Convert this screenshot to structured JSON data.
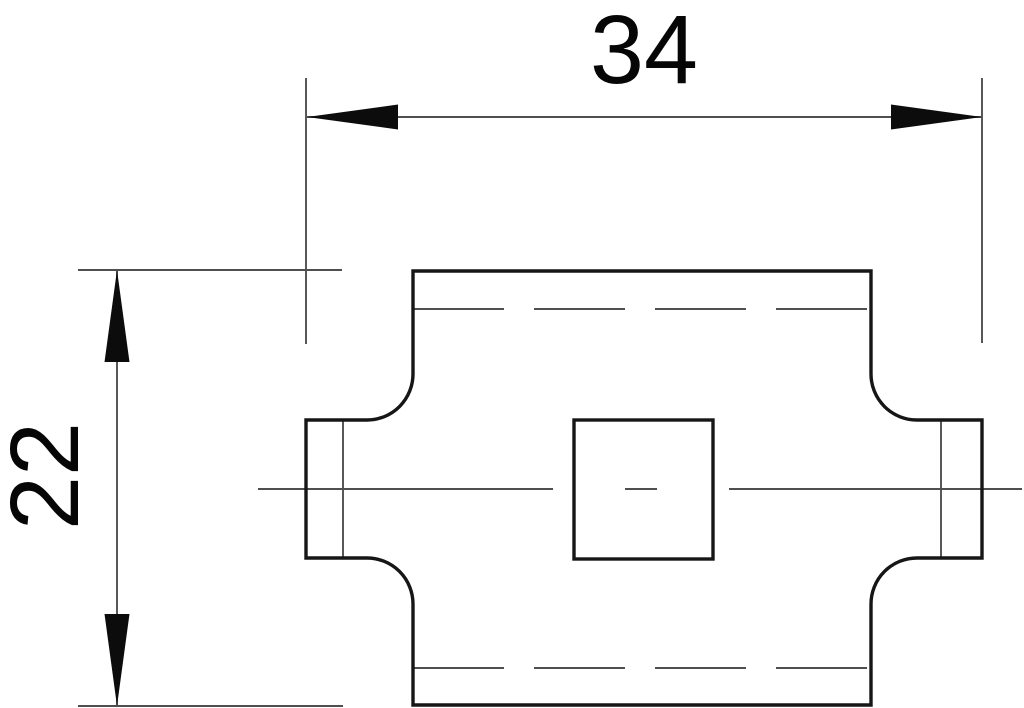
{
  "drawing": {
    "labels": {
      "width_dimension": "34",
      "height_dimension": "22"
    },
    "colors": {
      "background": "#ffffff",
      "outline": "#161616",
      "construction": "#4f4f4f",
      "arrow": "#0c0c0c",
      "text": "#060606"
    }
  }
}
